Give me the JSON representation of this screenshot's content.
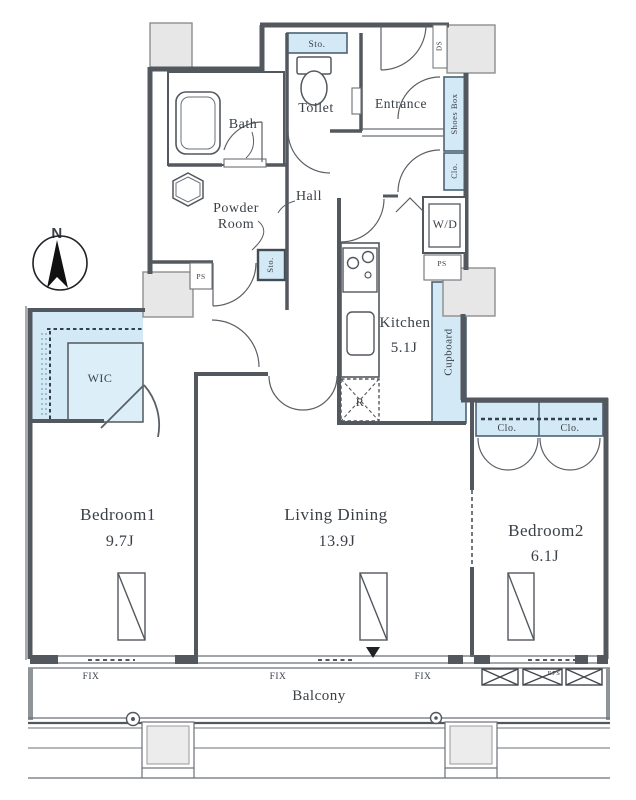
{
  "compass": {
    "label": "N"
  },
  "rooms": {
    "bath": {
      "name": "Bath"
    },
    "toilet": {
      "name": "Toilet"
    },
    "entrance": {
      "name": "Entrance"
    },
    "powder_room": {
      "line1": "Powder",
      "line2": "Room"
    },
    "hall": {
      "name": "Hall"
    },
    "kitchen": {
      "name": "Kitchen",
      "size": "5.1J"
    },
    "wic": {
      "name": "WIC"
    },
    "bedroom1": {
      "name": "Bedroom1",
      "size": "9.7J"
    },
    "living_dining": {
      "name": "Living Dining",
      "size": "13.9J"
    },
    "bedroom2": {
      "name": "Bedroom2",
      "size": "6.1J"
    },
    "balcony": {
      "name": "Balcony"
    }
  },
  "storage": {
    "sto_top": "Sto.",
    "sto_hall": "Sto.",
    "shoes_box": "Shoes Box",
    "clo_entrance": "Clo.",
    "cupboard": "Cupboard",
    "clo_bedroom2_left": "Clo.",
    "clo_bedroom2_right": "Clo.",
    "refrigerator": "R",
    "washer_dryer": "W/D"
  },
  "shafts": {
    "ds": "DS",
    "ps_left": "PS",
    "ps_right": "PS",
    "eps": "EPS"
  },
  "windows": {
    "fix_labels": [
      "FIX",
      "FIX",
      "FIX"
    ]
  },
  "colors": {
    "storage_fill": "#d4e9f6",
    "storage_border": "#4d6273",
    "wall": "#53585e",
    "pillar_fill": "#e7e7e7",
    "text": "#3a4047"
  }
}
